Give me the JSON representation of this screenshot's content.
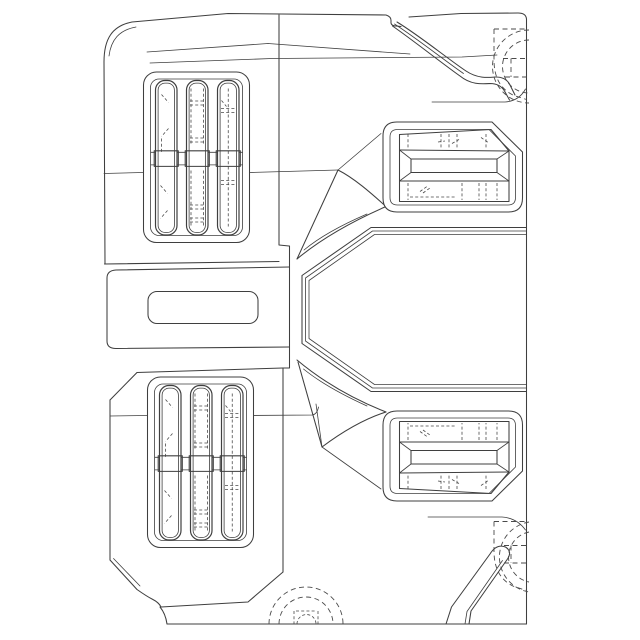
{
  "figure": {
    "type": "line-drawing",
    "style": "monochrome patent-style technical drawing",
    "subject": "vehicle fascia plan view with lamp clusters, step pockets and broken-line wheels"
  },
  "colors": {
    "background": "#ffffff",
    "line": "#3f3f3f",
    "dashed_line": "#4a4a4a"
  },
  "lamp_clusters": {
    "bezel": {
      "x": 143.5,
      "y": 72,
      "w": 106,
      "h": 170.5,
      "r": 13,
      "inner_inset": 7,
      "inner_r": 8.5
    },
    "slat": {
      "y": 80.5,
      "w": 21.5,
      "h": 154.5,
      "r": 9.5,
      "inner_inset": 2.6,
      "inner_r": 7
    },
    "slat_x": [
      155.5,
      186.5,
      217.5
    ],
    "crossbar": {
      "y": 150.8,
      "h": 15.6,
      "line_y1": 152.3,
      "line_y2": 164.9
    },
    "instances": [
      {
        "id": "upper-lamp-cluster",
        "dx": 0,
        "dy": 0
      },
      {
        "id": "lower-lamp-cluster",
        "dx": 4,
        "dy": 305
      }
    ],
    "slat_details": {
      "0": {
        "segs": [
          [
            6,
            14,
            13,
            22
          ],
          [
            13,
            48,
            6,
            56
          ],
          [
            6,
            58,
            6,
            72
          ],
          [
            5,
            105,
            12,
            113
          ],
          [
            12,
            130,
            5,
            138
          ]
        ],
        "vlines": [],
        "ticks": []
      },
      "1": {
        "segs": [],
        "vlines": [
          [
            4.5,
            8,
            64
          ],
          [
            17,
            8,
            64
          ],
          [
            4.5,
            90,
            146
          ],
          [
            17,
            90,
            146
          ]
        ],
        "ticks": [
          20.5,
          24.5,
          57.5,
          61.5,
          124.5,
          128.5,
          137.5,
          141.5
        ]
      },
      "2": {
        "segs": [
          [
            4,
            20,
            9,
            26
          ]
        ],
        "vlines": [
          [
            10.75,
            8,
            146
          ]
        ],
        "ticks": [
          28,
          32,
          100,
          104
        ]
      }
    }
  }
}
